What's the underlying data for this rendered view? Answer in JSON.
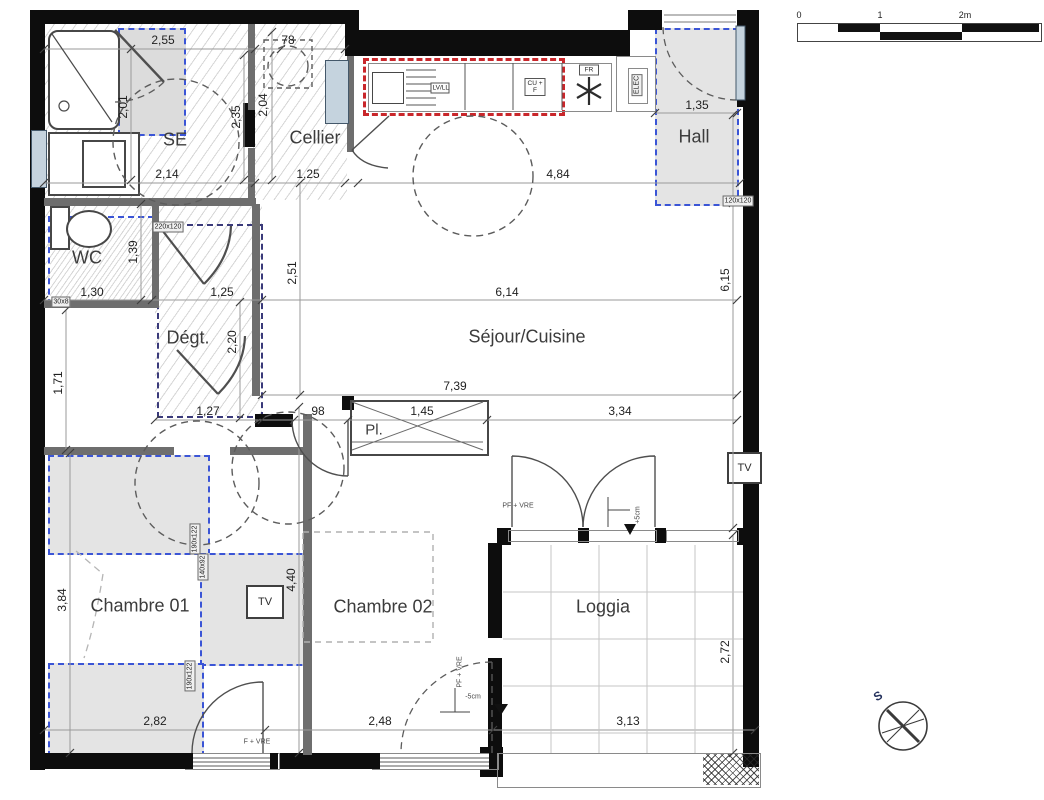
{
  "rooms": {
    "se": "SE",
    "cellier": "Cellier",
    "hall": "Hall",
    "wc": "WC",
    "degt": "Dégt.",
    "sejour": "Séjour/Cuisine",
    "pl": "Pl.",
    "ch1": "Chambre 01",
    "ch2": "Chambre 02",
    "loggia": "Loggia"
  },
  "dims": {
    "se_top": "2,55",
    "se_niche": "78",
    "se_bottom": "2,14",
    "cellier": "1,25",
    "kitchen": "4,84",
    "hall": "1,35",
    "wc_w": "1,30",
    "degt_w": "1,25",
    "sejour_w": "6,14",
    "sejour_w2": "7,39",
    "corr": "1,27",
    "opening": "98",
    "pl": "1,45",
    "sejour_e": "3,34",
    "ch1_w": "2,82",
    "ch2_w": "2,48",
    "loggia_w": "3,13",
    "se_h": "2,01",
    "se_h2": "2,35",
    "cellier_h": "2,04",
    "sejour_h": "6,15",
    "wc_h": "1,39",
    "sejour_h2": "2,51",
    "degt_h": "2,20",
    "corr_h": "1,71",
    "ch1_h": "3,84",
    "ch2_h": "4,40",
    "loggia_h": "2,72"
  },
  "tags": {
    "degt": "220x120",
    "hall": "120x120",
    "wc": "30x8",
    "ch1_a": "190x122",
    "ch1_b": "140x92",
    "ch1_c": "190x122",
    "elec": "ELEC"
  },
  "appliances": {
    "lv": "LV/LL",
    "cu": "CU + F",
    "fr": "FR"
  },
  "notes": {
    "f_vre": "F + VRE",
    "pf_vre": "PF + VRE",
    "pf_vre_v": "PF + VRE",
    "plus5": "+5cm",
    "minus5": "-5cm"
  },
  "fixtures": {
    "tv": "TV",
    "tv2": "TV"
  },
  "scalebar": {
    "t0": "0",
    "t1": "1",
    "t2": "2m"
  },
  "compass": {
    "south": "S"
  },
  "colors": {
    "wall": "#0d0d0d",
    "blue_dash": "#3b55d6",
    "red_dash": "#c9272b",
    "gray_fill": "#e4e4e4"
  }
}
